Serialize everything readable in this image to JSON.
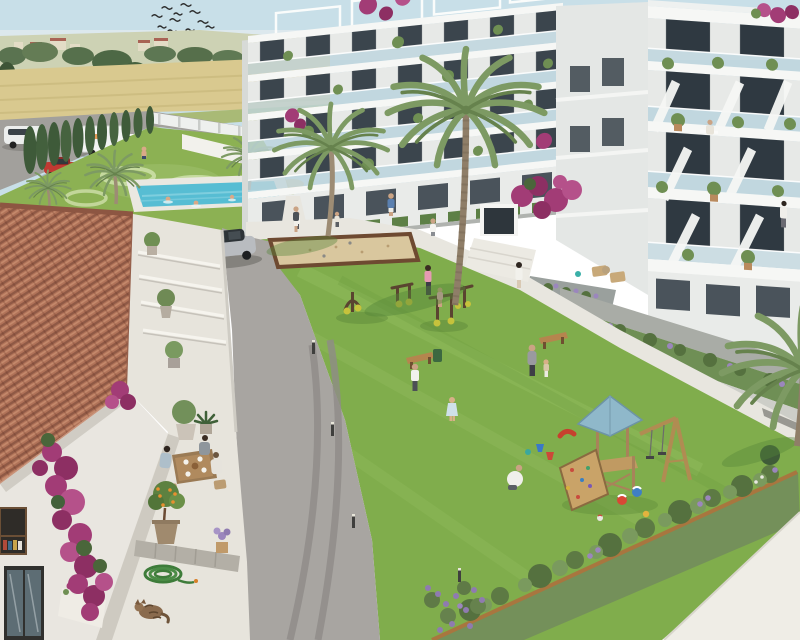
{
  "meta": {
    "title": "Aerial render of a new-build apartment complex with landscaped communal courtyard",
    "type": "architectural-visualization"
  },
  "palette": {
    "sky": "#c8dfe8",
    "horizon": "#e9eef0",
    "hills": "#cdd2b4",
    "field": "#d9c98f",
    "field_green": "#a9ba76",
    "asphalt_far": "#a2a09c",
    "asphalt": "#a8a5a1",
    "lawn": "#80ad4c",
    "pool_lawn": "#8cb153",
    "pool_water": "#57bdd3",
    "deck": "#eae8e1",
    "concrete": "#e8e6df",
    "path_light": "#efede6",
    "facade": "#f3f4f2",
    "facade_shaded": "#e4e7e5",
    "glass": "#bfd4dc",
    "window": "#39434b",
    "roof_tile": "#b07258",
    "terrace_stone": "#e7e4dc",
    "stone_wall": "#a9aca6",
    "sand": "#d9c79e",
    "sand_rim": "#6e4a31",
    "wood": "#b9905c",
    "play_roof": "#8fb8ca",
    "bougainvillea": "#a23c76",
    "lavender": "#9b86bd",
    "shrub": "#5d7a44",
    "border_green": "#74905a",
    "cypress": "#3e5a39",
    "palm_frond": "#7d9a63",
    "palm_trunk": "#9d8c74",
    "gym_accent": "#c6c23c",
    "suv_silver": "#b9bcc0",
    "car_red": "#c03a32",
    "truck_white": "#f2f3f2"
  },
  "scene": {
    "environment": {
      "sky": "clear pale blue sky",
      "birds_flying": 13,
      "backdrop": "farm fields, tree line and distant village houses"
    },
    "perimeter": {
      "vehicles": [
        "white van",
        "white box truck",
        "red car",
        "silver SUV"
      ],
      "hedge": "row of 11 cypress trees along the road",
      "fence": "low white perimeter wall"
    },
    "amenities": [
      {
        "label": "lap pool",
        "swimmers": 3
      },
      {
        "label": "ornamental lawn with mowing swirls"
      },
      {
        "label": "petanque sand court"
      },
      {
        "label": "outdoor gym",
        "machines": 4
      },
      {
        "label": "wooden playground",
        "items": [
          "tower with blue roof",
          "climbing ramp",
          "double swing",
          "beach balls",
          "toy buckets"
        ]
      },
      {
        "label": "wooden benches",
        "count": 2
      }
    ],
    "buildings": {
      "left_block": {
        "floors": 5,
        "features": [
          "roof pergolas",
          "glass balconies",
          "bougainvillea",
          "balcony plants"
        ]
      },
      "right_block": {
        "floors": 5,
        "features": [
          "angled white balcony wings",
          "glass balustrades",
          "terraced planters",
          "residents on balconies"
        ]
      }
    },
    "courtyard_people": 14,
    "foreground_house": {
      "roof": "terracotta tiled roof",
      "wall": "white render covered in bougainvillea",
      "terrace": [
        "family dining at wooden table",
        "potted citrus tree",
        "coiled garden hose",
        "sleeping cat",
        "olive pots on steps",
        "lavender pot on low wall"
      ]
    },
    "vegetation": {
      "palms": 6,
      "lavender": "purple flower borders",
      "shrub_border": "mixed shrub bed along lower edge"
    }
  }
}
